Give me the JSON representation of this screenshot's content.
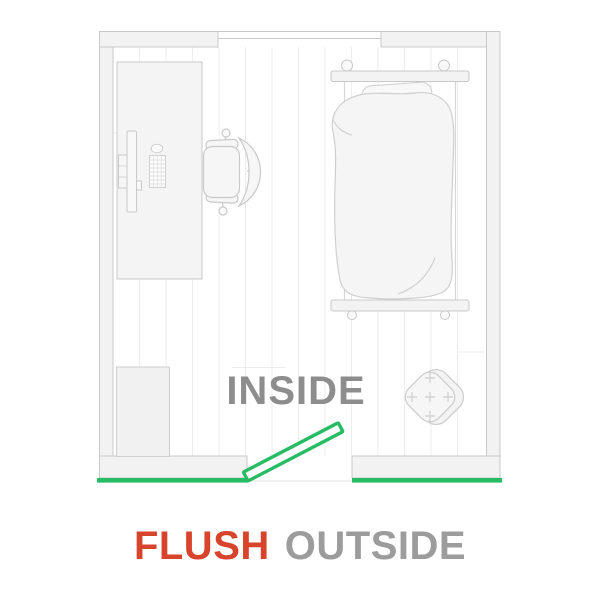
{
  "diagram": {
    "inside_label": "INSIDE",
    "caption_flush": "FLUSH",
    "caption_outside": "OUTSIDE",
    "colors": {
      "accent_green": "#27bc64",
      "flush_red": "#d8432c",
      "inside_gray": "#8d8d8d",
      "outside_gray": "#9c9c9c",
      "outline_gray": "#c9c9c9",
      "wall_fill": "#f2f2f2"
    },
    "room_items": [
      "desk",
      "office-chair",
      "bed",
      "accent-chair",
      "closet",
      "window",
      "door-open-inward"
    ],
    "door": {
      "highlight": "flush mounted outside, opens inside"
    }
  }
}
